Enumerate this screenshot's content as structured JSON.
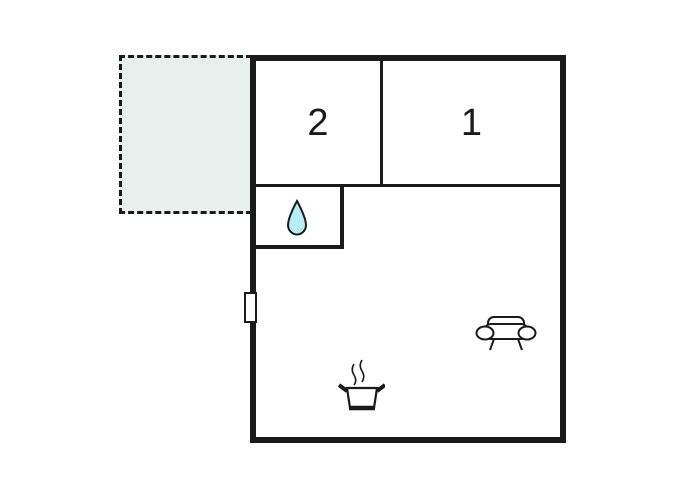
{
  "floorplan": {
    "type": "property-floor-plan",
    "background_color": "#ffffff",
    "wall_color": "#1a1a1a",
    "terrace": {
      "name": "terrace-patio",
      "fill_color": "#e9efed",
      "border_style": "dashed",
      "label": ""
    },
    "rooms": {
      "room2": {
        "label": "2"
      },
      "room1": {
        "label": "1"
      },
      "bathroom": {
        "label": "",
        "icon": "water-drop-icon",
        "icon_fill_color": "#b6eef6"
      },
      "living_area": {
        "label": "",
        "icons": [
          "cooking-pot-icon",
          "sofa-icon"
        ]
      }
    },
    "markers": {
      "window": "window-marker"
    }
  }
}
